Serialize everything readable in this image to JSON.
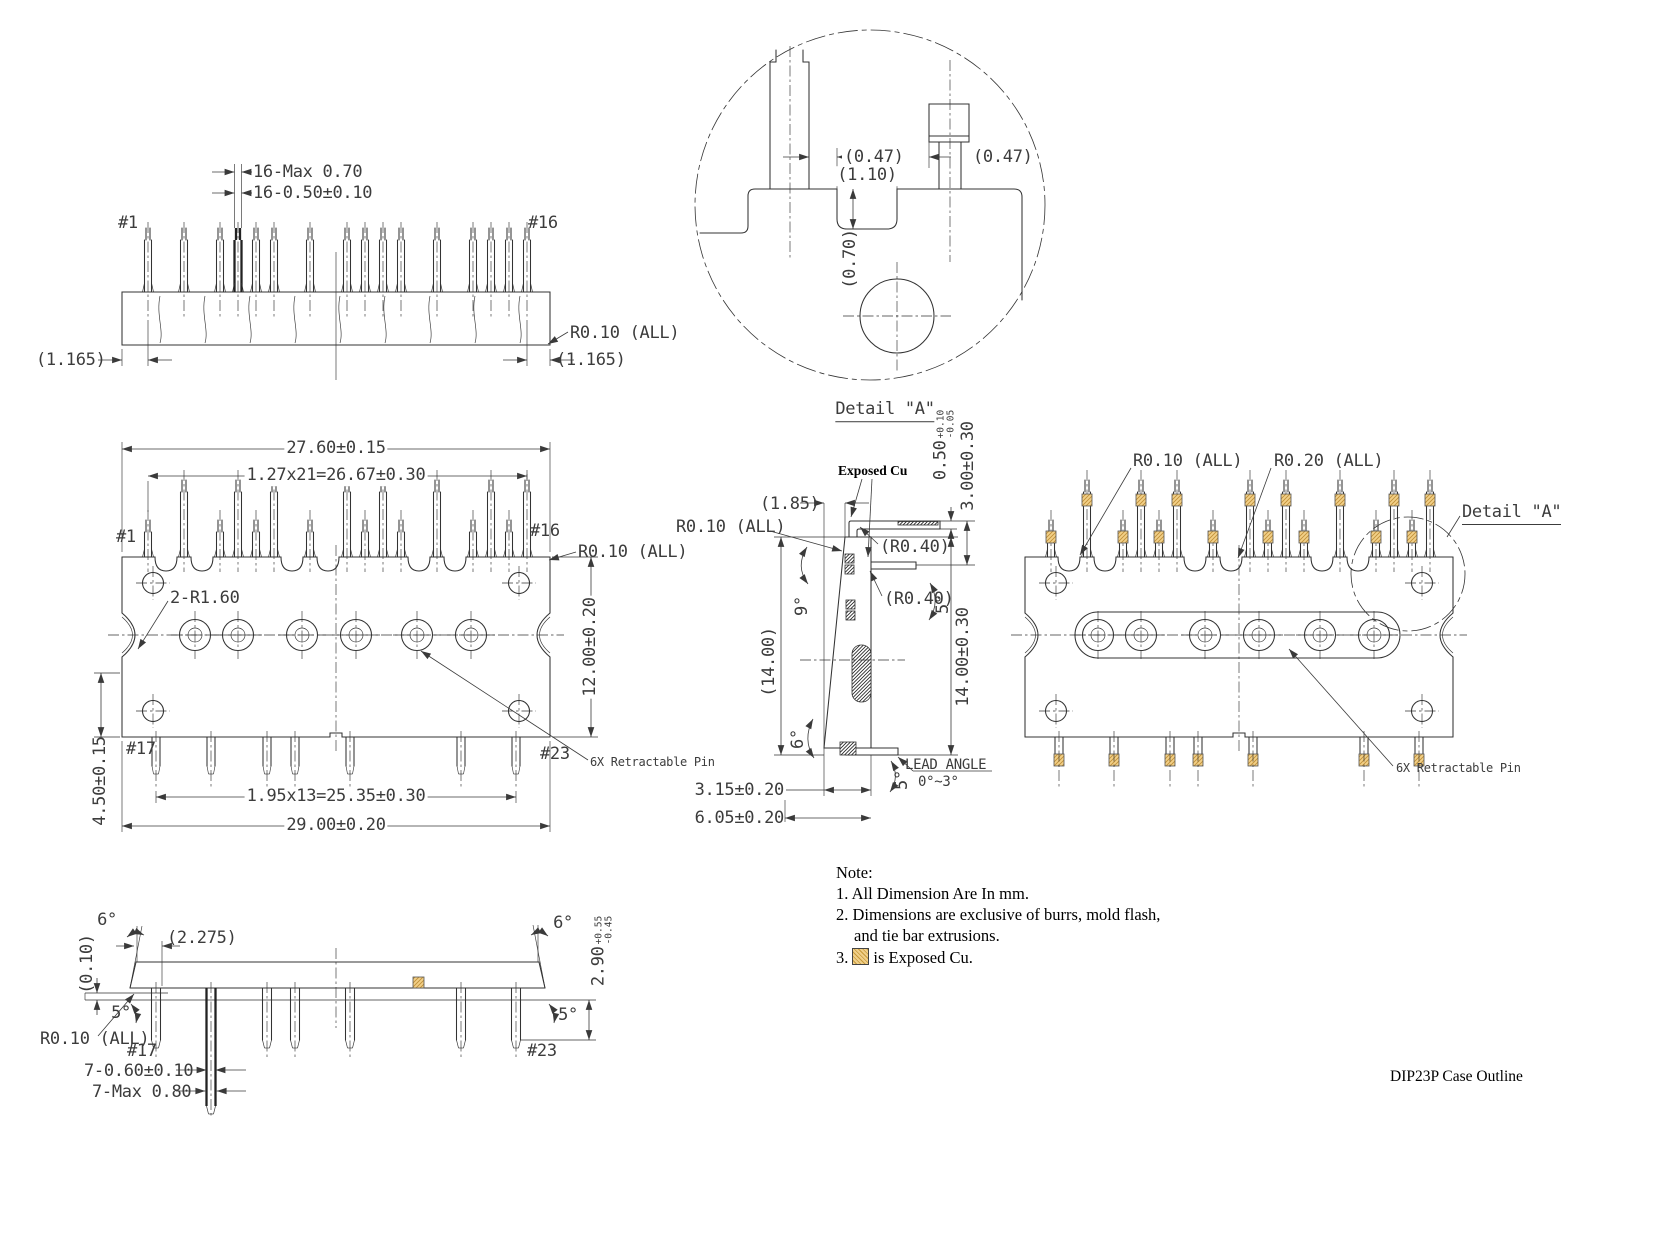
{
  "title": "DIP23P Case Outline",
  "notes": {
    "heading": "Note:",
    "n1": "1. All Dimension Are In mm.",
    "n2": "2. Dimensions are exclusive of burrs, mold flash,",
    "n2b": "and tie bar extrusions.",
    "n3a": "3.",
    "n3b": "is Exposed Cu."
  },
  "top_view": {
    "pin_first": "#1",
    "pin_last": "#16",
    "dim_pin_max": "16-Max 0.70",
    "dim_pin_nom": "16-0.50±0.10",
    "offset_left": "(1.165)",
    "offset_right": "(1.165)",
    "radius_all": "R0.10 (ALL)"
  },
  "front_view": {
    "pin_first": "#1",
    "pin_last": "#16",
    "pin_b_first": "#17",
    "pin_b_last": "#23",
    "body_width": "27.60±0.15",
    "pin_pitch": "1.27x21=26.67±0.30",
    "radius_all": "R0.10 (ALL)",
    "corner_radius": "2-R1.60",
    "body_height": "12.00±0.20",
    "pin_offset": "4.50±0.15",
    "pin_pitch_bottom": "1.95x13=25.35±0.30",
    "overall_width": "29.00±0.20",
    "retractable": "6X Retractable Pin"
  },
  "side_view": {
    "body_top_width": "(1.85)",
    "radius_all": "R0.10 (ALL)",
    "exposed_cu": "Exposed Cu",
    "lead_thickness": {
      "v": "0.50",
      "p": "+0.10",
      "m": "-0.05"
    },
    "lead_height": "3.00±0.30",
    "bend_radius_top": "(R0.40)",
    "bend_radius_bot": "(R0.40)",
    "angle_9": "9°",
    "angle_5_top": "5°",
    "body_height_ref": "(14.00)",
    "body_height": "14.00±0.30",
    "angle_6": "6°",
    "angle_5_bot": "5°",
    "lead_angle_label": "LEAD ANGLE",
    "lead_angle_value": "0°~3°",
    "body_thickness": "3.15±0.20",
    "overall_thickness": "6.05±0.20"
  },
  "right_view": {
    "radius_10": "R0.10 (ALL)",
    "radius_20": "R0.20 (ALL)",
    "detail": "Detail \"A\"",
    "retractable": "6X Retractable Pin"
  },
  "bottom_view": {
    "angle_6_left": "6°",
    "pin_offset": "(2.275)",
    "standoff": "(0.10)",
    "angle_5_left": "5°",
    "radius_all": "R0.10 (ALL)",
    "pin_first": "#17",
    "pin_last": "#23",
    "angle_6_right": "6°",
    "tip_length": {
      "v": "2.90",
      "p": "+0.55",
      "m": "-0.45"
    },
    "angle_5_right": "5°",
    "pin_width_nom": "7-0.60±0.10",
    "pin_width_max": "7-Max 0.80"
  },
  "detail_a": {
    "label": "Detail \"A\"",
    "clearance_left": "(0.47)",
    "slot_width": "(1.10)",
    "clearance_right": "(0.47)",
    "slot_depth": "(0.70)"
  }
}
